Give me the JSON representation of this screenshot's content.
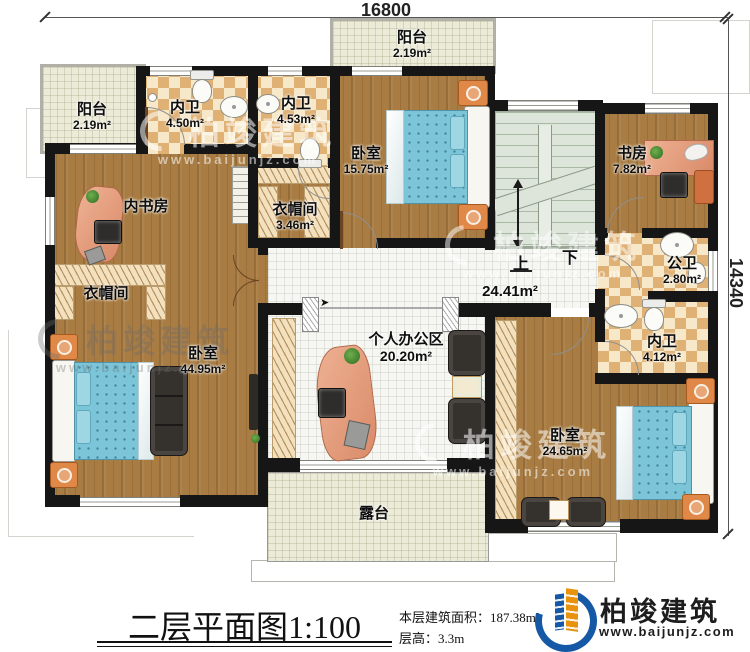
{
  "dimensions": {
    "width_mm": "16800",
    "height_mm": "14340"
  },
  "rooms": {
    "balcony_left": {
      "name": "阳台",
      "area": "2.19m²"
    },
    "bath_inner_a": {
      "name": "内卫",
      "area": "4.50m²"
    },
    "bath_inner_b": {
      "name": "内卫",
      "area": "4.53m²"
    },
    "balcony_top": {
      "name": "阳台",
      "area": "2.19m²"
    },
    "bedroom_top": {
      "name": "卧室",
      "area": "15.75m²"
    },
    "study": {
      "name": "书房",
      "area": "7.82m²"
    },
    "inner_study": {
      "name": "内书房",
      "area": ""
    },
    "closet_small": {
      "name": "衣帽间",
      "area": "3.46m²"
    },
    "closet_left": {
      "name": "衣帽间",
      "area": ""
    },
    "bedroom_left": {
      "name": "卧室",
      "area": "44.95m²"
    },
    "office": {
      "name": "个人办公区",
      "area": "20.20m²"
    },
    "hall": {
      "area": "24.41m²"
    },
    "bath_public": {
      "name": "公卫",
      "area": "2.80m²"
    },
    "bath_inner_c": {
      "name": "内卫",
      "area": "4.12m²"
    },
    "bedroom_right": {
      "name": "卧室",
      "area": "24.65m²"
    },
    "terrace": {
      "name": "露台",
      "area": ""
    }
  },
  "stairs": {
    "up": "上",
    "down": "下"
  },
  "watermark": {
    "brand": "柏竣建筑",
    "url": "www.baijunjz.com"
  },
  "logo": {
    "brand": "柏竣建筑",
    "url": "www.baijunjz.com"
  },
  "title_block": {
    "title": "二层平面图",
    "scale": "1:100",
    "area_label": "本层建筑面积：",
    "area_value": "187.38m²",
    "height_label": "层高：",
    "height_value": "3.3m"
  },
  "colors": {
    "logo_blue": "#1559a6",
    "logo_orange": "#e8920e",
    "wall": "#161616",
    "wood": "#a87c42",
    "tile_tan": "#e0b175",
    "mattress_blue": "#7cc5d8"
  }
}
